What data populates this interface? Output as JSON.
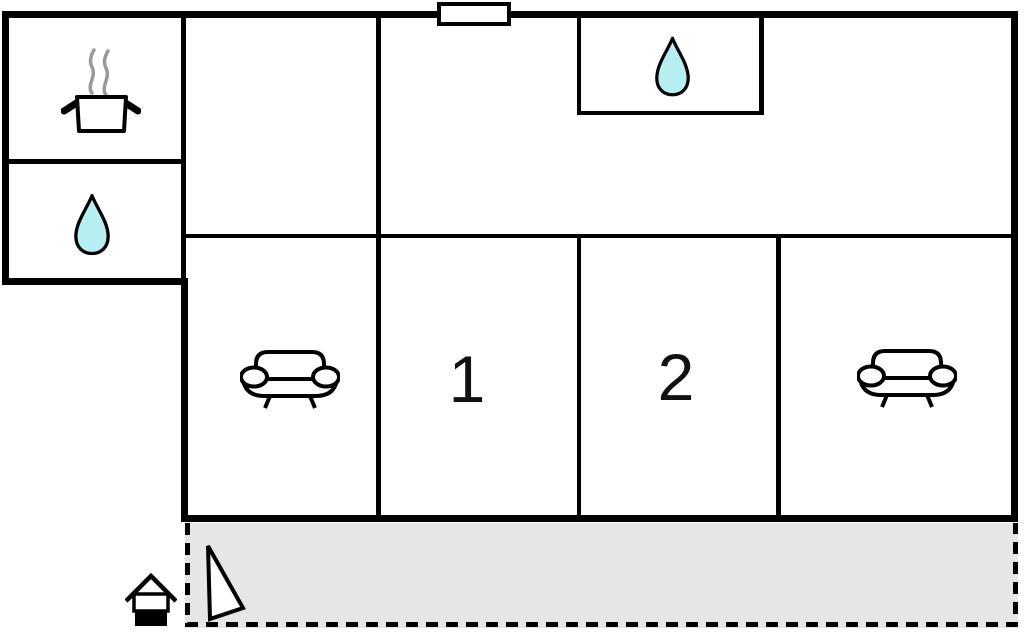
{
  "plan": {
    "title": "holiday-home-floor-plan",
    "colors": {
      "wall": "#000000",
      "water": "#b6eef2",
      "terrace-fill": "#e6e6e6",
      "steam": "#999999",
      "label": "#111111"
    },
    "rooms": {
      "kitchen": {
        "icon": "cooking-pot-icon"
      },
      "bath_annex": {
        "icon": "water-drop-icon"
      },
      "shower_room": {
        "icon": "water-drop-icon"
      },
      "lounge_left": {
        "icon": "sofa-icon"
      },
      "bedroom_1": {
        "label": "1"
      },
      "bedroom_2": {
        "label": "2"
      },
      "lounge_right": {
        "icon": "sofa-icon"
      },
      "terrace": {
        "markers": [
          "triangle-icon"
        ]
      }
    },
    "outside": {
      "entrance_marker": "house-icon"
    }
  }
}
